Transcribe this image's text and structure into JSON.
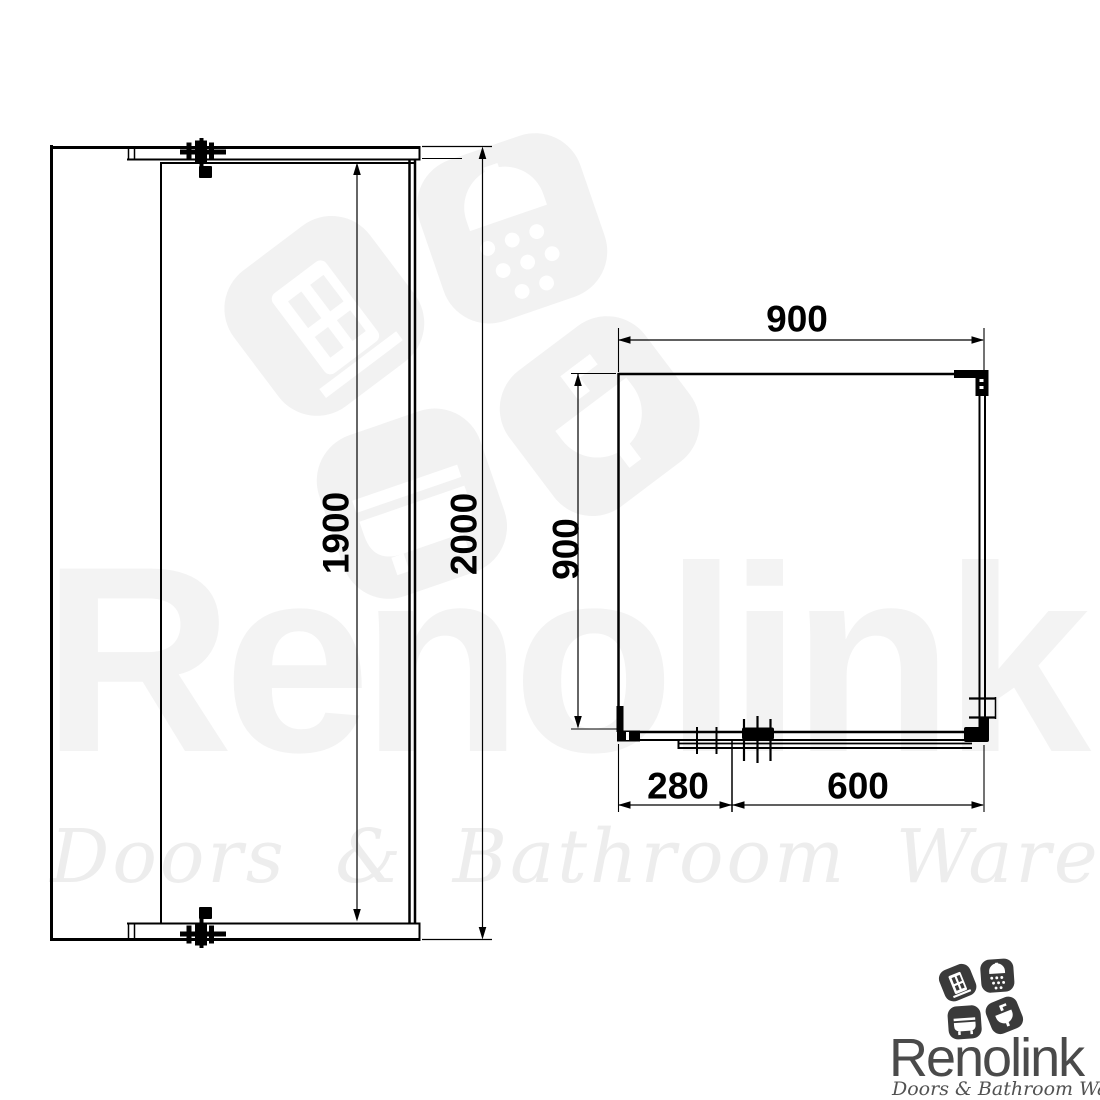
{
  "drawing": {
    "type": "shower-enclosure-technical-drawing",
    "elevation_view": {
      "glass_height_label": "1900",
      "total_height_label": "2000"
    },
    "plan_view": {
      "width_label": "900",
      "depth_label": "900",
      "fixed_panel_label": "280",
      "door_label": "600"
    }
  },
  "watermark": {
    "brand": "Renolink",
    "tagline": "Doors & Bathroom Warehouse"
  },
  "logo": {
    "brand": "Renolink",
    "tagline": "Doors & Bathroom Warehouse",
    "tile_icons": [
      "door-icon",
      "shower-icon",
      "bathtub-icon",
      "sink-icon"
    ],
    "colors": {
      "tile": "#3a3a3a",
      "brand_text": "#4a4a4a",
      "tagline_text": "#525252"
    }
  },
  "colors": {
    "background": "#ffffff",
    "line": "#000000",
    "watermark_text": "#f3f3f3",
    "watermark_mark": "#f2f2f2"
  }
}
